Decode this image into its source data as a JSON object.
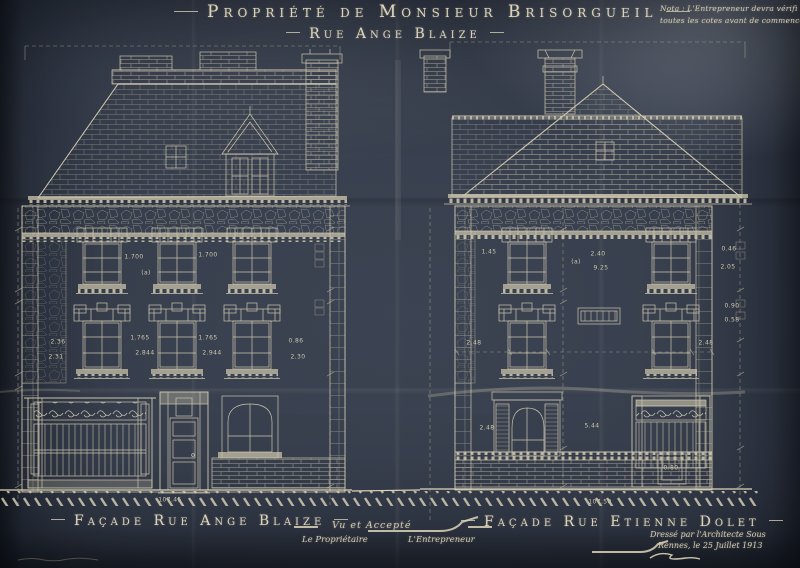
{
  "header": {
    "title": "Propriété de Monsieur Brisorgueil",
    "subtitle": "Rue Ange Blaize",
    "nota_line1": "Nota : L'Entrepreneur devra vérifi",
    "nota_line2": "toutes les cotes avant de commencer l"
  },
  "facades": {
    "left": {
      "label": "Façade Rue Ange Blaize"
    },
    "right": {
      "label": "Façade Rue Etienne Dolet"
    }
  },
  "signoff": {
    "approval": "Vu et Accepté",
    "owner": "Le Propriétaire",
    "contractor": "L'Entrepreneur",
    "architect": "Dressé par l'Architecte Sous",
    "place_date": "Rennes, le 25 Juillet 1913"
  },
  "colors": {
    "paper": "#343b49",
    "ink": "#d9d1b6"
  },
  "dimensions": [
    {
      "t": "1.700",
      "x": 134,
      "y": 257
    },
    {
      "t": "1.700",
      "x": 208,
      "y": 255
    },
    {
      "t": "(a)",
      "x": 146,
      "y": 273
    },
    {
      "t": "2.36",
      "x": 58,
      "y": 342
    },
    {
      "t": "2.31",
      "x": 56,
      "y": 357
    },
    {
      "t": "1.765",
      "x": 140,
      "y": 338
    },
    {
      "t": "2.844",
      "x": 145,
      "y": 353
    },
    {
      "t": "1.765",
      "x": 208,
      "y": 338
    },
    {
      "t": "2.944",
      "x": 212,
      "y": 353
    },
    {
      "t": "0.86",
      "x": 296,
      "y": 341
    },
    {
      "t": "2.30",
      "x": 298,
      "y": 357
    },
    {
      "t": "107.45",
      "x": 170,
      "y": 500
    },
    {
      "t": "1.45",
      "x": 489,
      "y": 252
    },
    {
      "t": "2.40",
      "x": 598,
      "y": 254
    },
    {
      "t": "9.25",
      "x": 601,
      "y": 268
    },
    {
      "t": "(a)",
      "x": 576,
      "y": 262
    },
    {
      "t": "2.48",
      "x": 474,
      "y": 343
    },
    {
      "t": "2.48",
      "x": 706,
      "y": 343
    },
    {
      "t": "2.48",
      "x": 487,
      "y": 428
    },
    {
      "t": "5.44",
      "x": 592,
      "y": 426
    },
    {
      "t": "0.80",
      "x": 671,
      "y": 468
    },
    {
      "t": "107.50",
      "x": 600,
      "y": 502
    },
    {
      "t": "0.46",
      "x": 729,
      "y": 249
    },
    {
      "t": "2.05",
      "x": 728,
      "y": 267
    },
    {
      "t": "0.90",
      "x": 732,
      "y": 306
    },
    {
      "t": "0.58",
      "x": 732,
      "y": 320
    }
  ]
}
